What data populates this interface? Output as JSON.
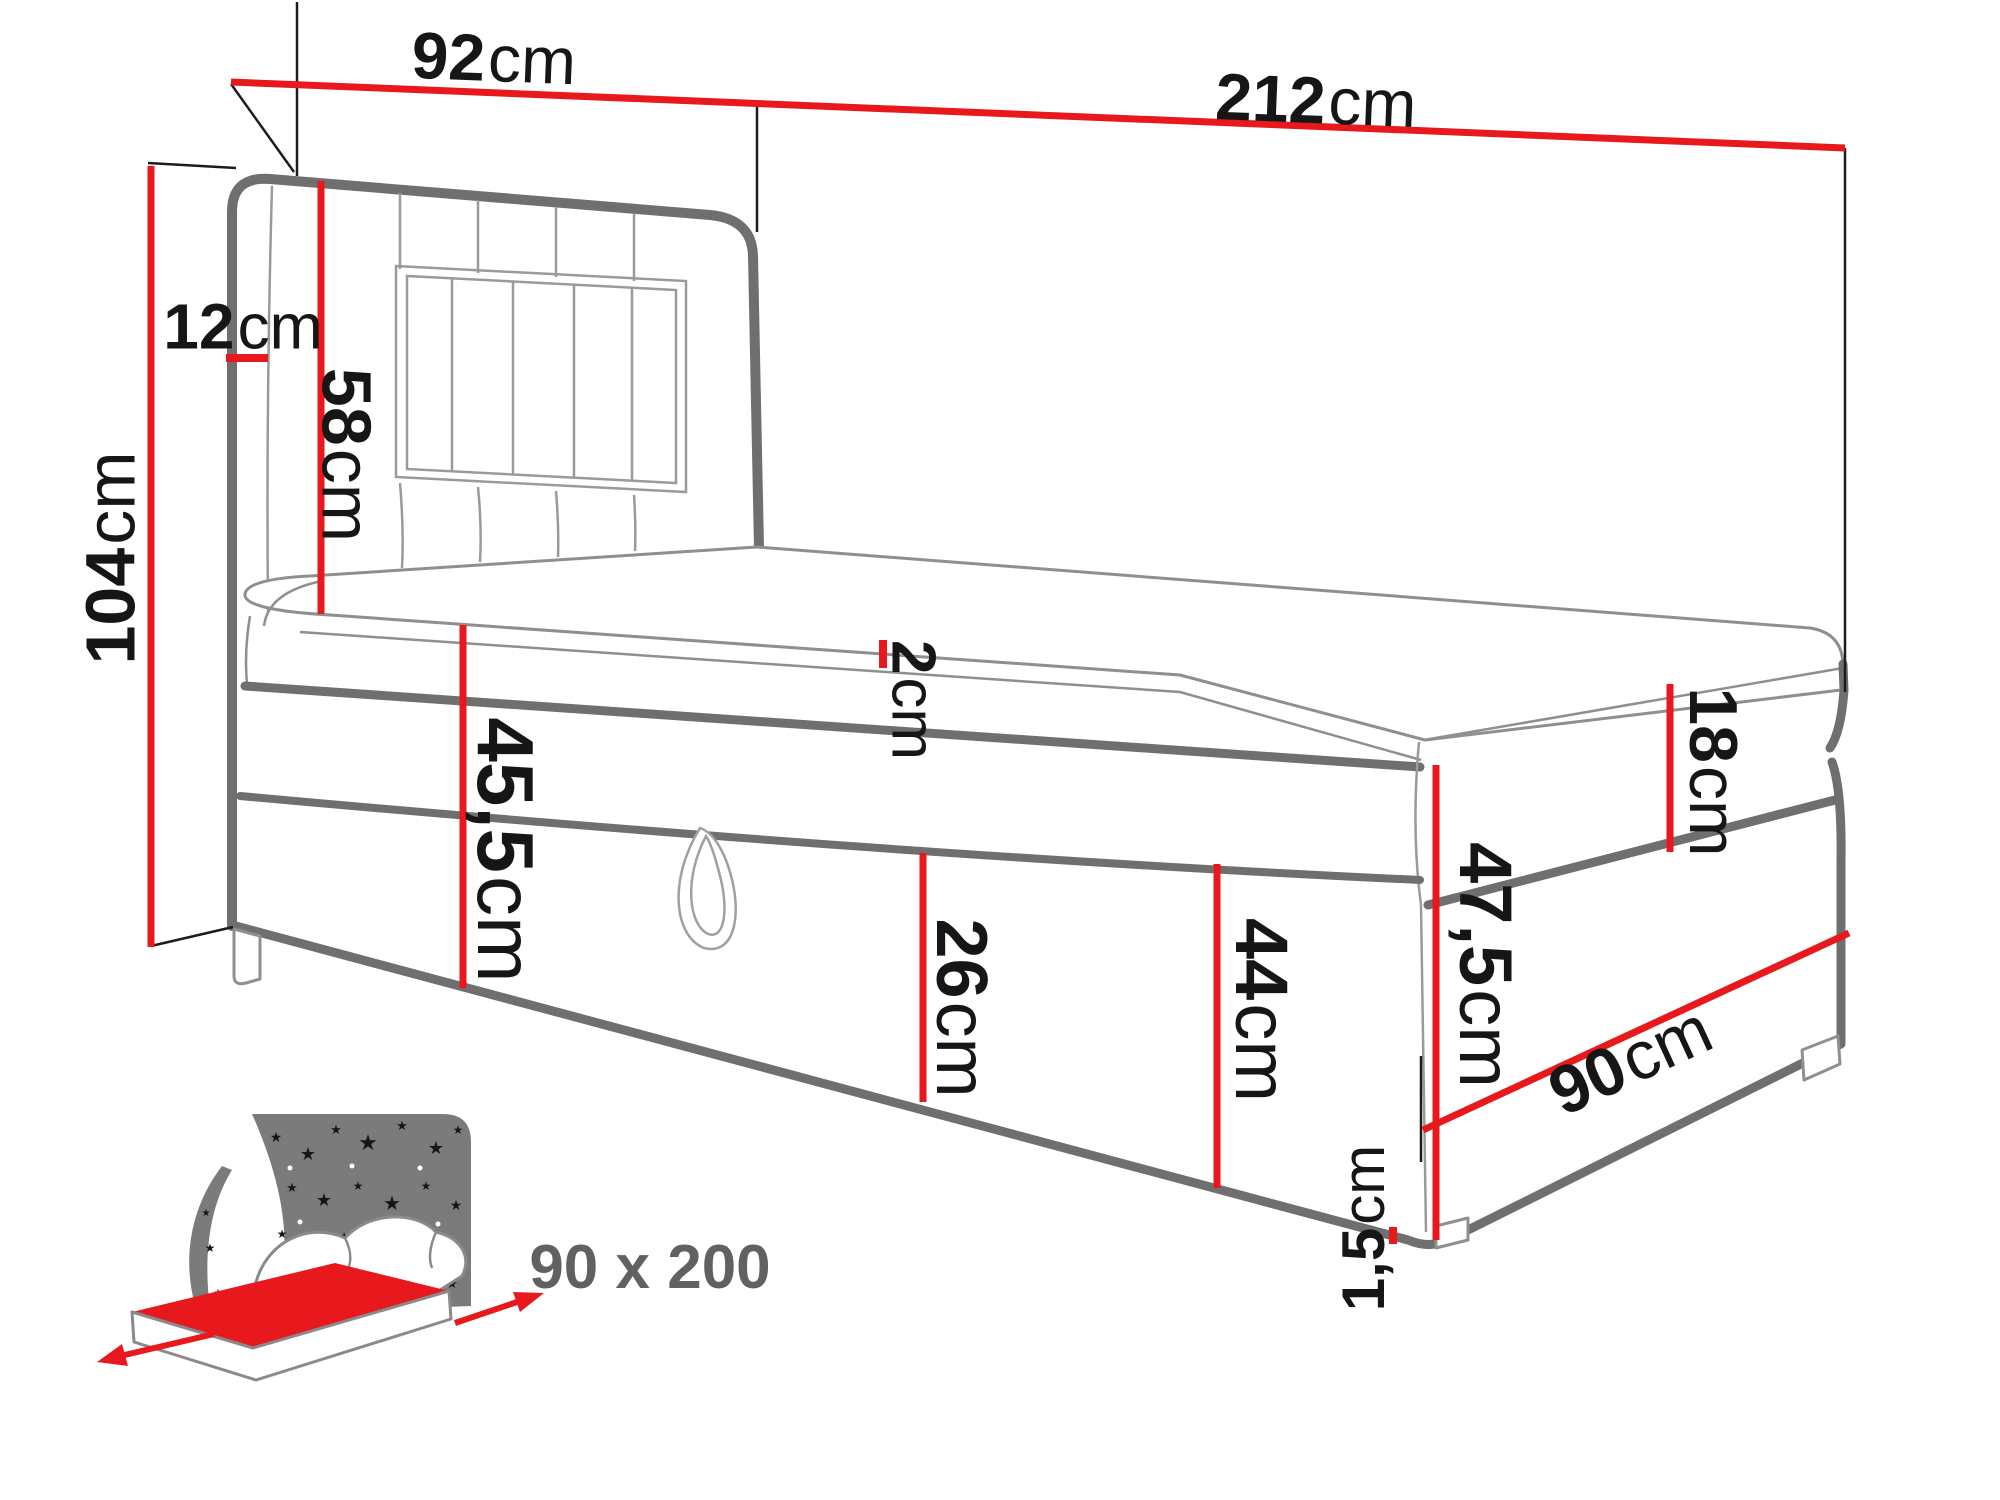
{
  "colors": {
    "dimension_red": "#e8191c",
    "outline_dark_gray": "#6f6f6f",
    "outline_light_gray": "#9a9a9a",
    "label_black": "#161616",
    "icon_gray": "#7b7b7b",
    "badge_gray": "#616161"
  },
  "dims": [
    {
      "name": "headboard-width",
      "value": "92",
      "unit": "cm"
    },
    {
      "name": "total-length",
      "value": "212",
      "unit": "cm"
    },
    {
      "name": "total-height",
      "value": "104",
      "unit": "cm"
    },
    {
      "name": "headboard-depth",
      "value": "12",
      "unit": "cm"
    },
    {
      "name": "headboard-above-mattress",
      "value": "58",
      "unit": "cm"
    },
    {
      "name": "topper-thickness",
      "value": "2",
      "unit": "cm"
    },
    {
      "name": "base-height-head-side",
      "value": "45,5",
      "unit": "cm"
    },
    {
      "name": "storage-flap-height",
      "value": "26",
      "unit": "cm"
    },
    {
      "name": "base-height-foot-side",
      "value": "44",
      "unit": "cm"
    },
    {
      "name": "side-height",
      "value": "47,5",
      "unit": "cm"
    },
    {
      "name": "mattress-thickness",
      "value": "18",
      "unit": "cm"
    },
    {
      "name": "bed-width",
      "value": "90",
      "unit": "cm"
    },
    {
      "name": "leg-height",
      "value": "1,5",
      "unit": "cm"
    }
  ],
  "badge": {
    "label": "90 x 200"
  }
}
